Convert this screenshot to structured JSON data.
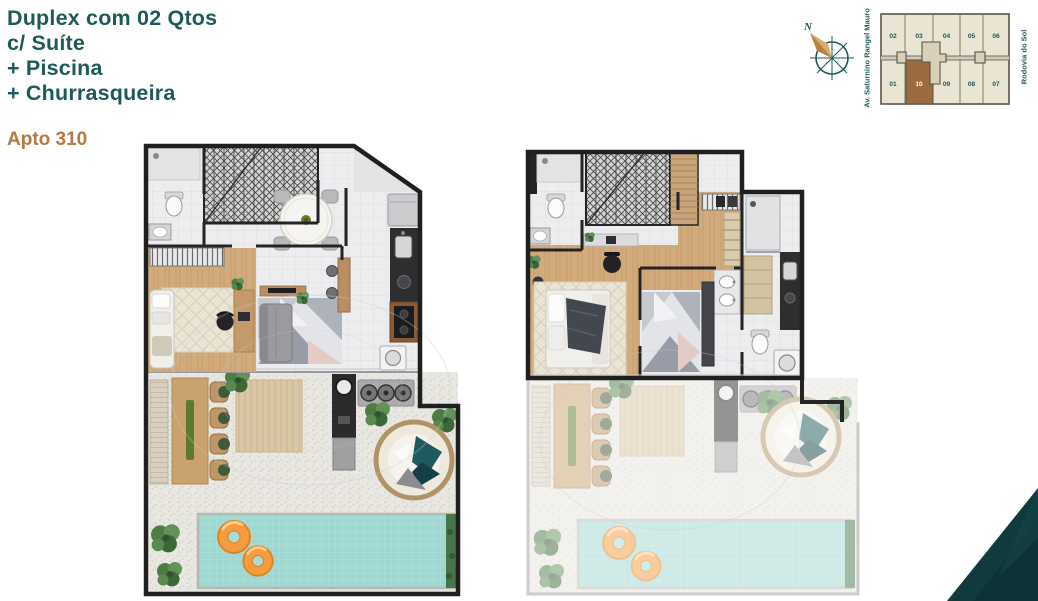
{
  "header": {
    "title_lines": [
      "Duplex com 02 Qtos",
      "c/ Suíte",
      "+ Piscina",
      "+ Churrasqueira"
    ],
    "apartment_label": "Apto 310"
  },
  "compass": {
    "north_label": "N"
  },
  "streets": {
    "left": "Av. Saturnino Rangel Mauro",
    "right": "Rodovia do Sol"
  },
  "key_plan": {
    "top_row": [
      "02",
      "03",
      "04",
      "05",
      "06"
    ],
    "bottom_row": [
      "01",
      "10",
      "09",
      "08",
      "07"
    ],
    "highlighted_unit": "10"
  },
  "floor_plans": {
    "lower": {
      "id": "floor-plan-lower",
      "rooms": [
        "bathroom",
        "staircase",
        "dining",
        "bedroom-office",
        "living",
        "kitchen",
        "gourmet-terrace",
        "barbecue",
        "pool"
      ]
    },
    "upper": {
      "id": "floor-plan-upper",
      "rooms": [
        "bathroom",
        "staircase",
        "suite-bedroom",
        "closet-vanity",
        "suite-bathroom",
        "terrace-below",
        "pool-below"
      ]
    }
  },
  "colors": {
    "title_teal": "#1d5a58",
    "apartment_brown": "#b5793f",
    "keyplan_highlight": "#9c6b3f",
    "keyplan_bg": "#eae4d2",
    "pool_water": "#9fd7d1",
    "float_orange": "#f59c3e",
    "wood": "#d2ab7c",
    "corner_accent": "#113a3d"
  }
}
